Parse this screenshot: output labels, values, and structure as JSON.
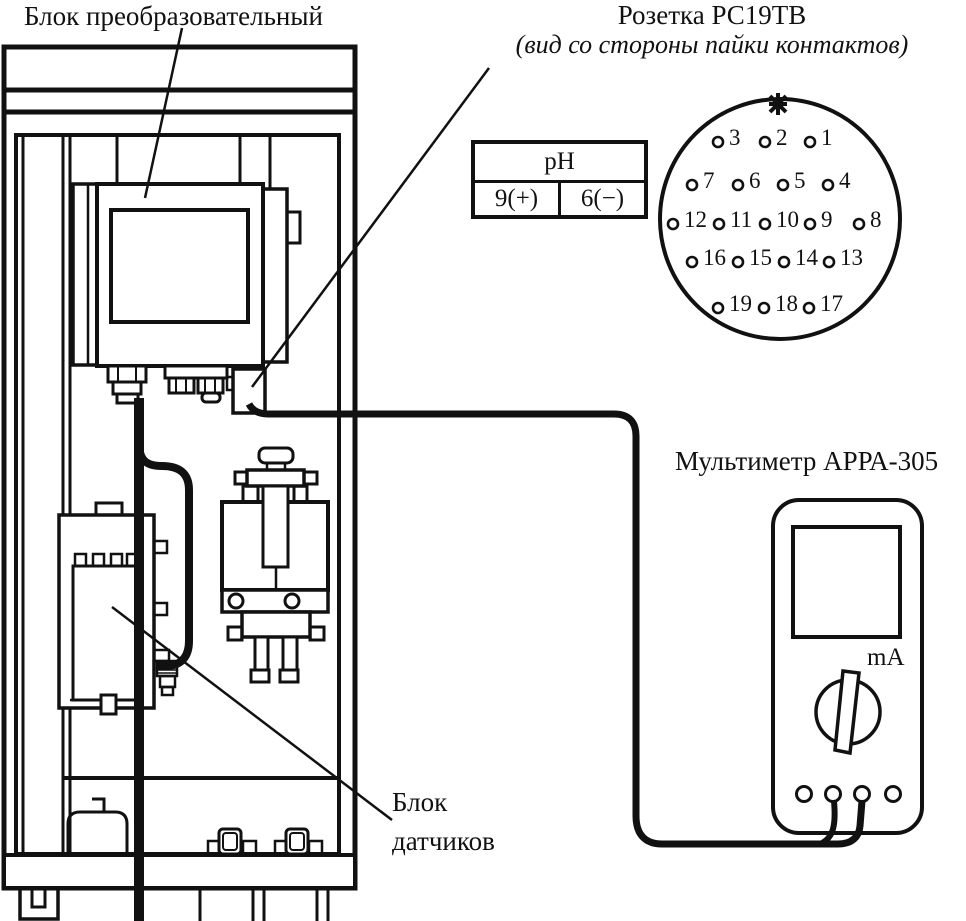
{
  "diagram": {
    "converter_label": "Блок преобразовательный",
    "socket": {
      "title": "Розетка РС19ТВ",
      "subtitle": "(вид со стороны пайки контактов)"
    },
    "ph_table": {
      "header": "pH",
      "cells": [
        "9(+)",
        "6(−)"
      ]
    },
    "connector_pins": [
      {
        "n": 1,
        "x": 810,
        "y": 142
      },
      {
        "n": 2,
        "x": 765,
        "y": 142
      },
      {
        "n": 3,
        "x": 718,
        "y": 142
      },
      {
        "n": 4,
        "x": 828,
        "y": 185
      },
      {
        "n": 5,
        "x": 783,
        "y": 185
      },
      {
        "n": 6,
        "x": 738,
        "y": 185
      },
      {
        "n": 7,
        "x": 692,
        "y": 185
      },
      {
        "n": 8,
        "x": 859,
        "y": 224
      },
      {
        "n": 9,
        "x": 810,
        "y": 224
      },
      {
        "n": 10,
        "x": 765,
        "y": 224
      },
      {
        "n": 11,
        "x": 719,
        "y": 224
      },
      {
        "n": 12,
        "x": 673,
        "y": 224
      },
      {
        "n": 13,
        "x": 829,
        "y": 262
      },
      {
        "n": 14,
        "x": 784,
        "y": 262
      },
      {
        "n": 15,
        "x": 738,
        "y": 262
      },
      {
        "n": 16,
        "x": 692,
        "y": 262
      },
      {
        "n": 17,
        "x": 809,
        "y": 308
      },
      {
        "n": 18,
        "x": 764,
        "y": 308
      },
      {
        "n": 19,
        "x": 718,
        "y": 308
      }
    ],
    "multimeter": {
      "label": "Мультиметр АРРА-305",
      "mode_label": "mA"
    },
    "sensor_label_lines": [
      "Блок",
      "датчиков"
    ],
    "colors": {
      "ink": "#111111",
      "paper": "#ffffff"
    }
  }
}
